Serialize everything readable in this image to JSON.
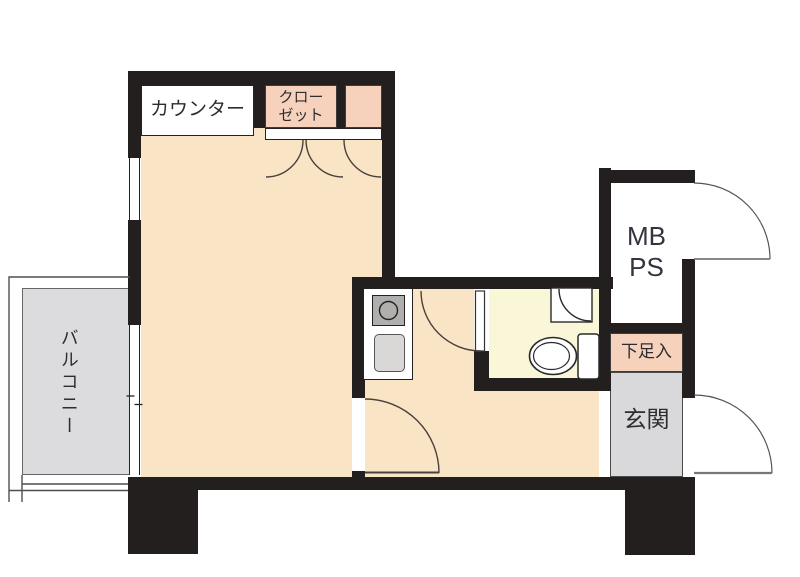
{
  "plan_title": "studio-apartment-floor-plan",
  "rooms": {
    "balcony": {
      "label": "バルコニー",
      "floor_color": "#dcdcde"
    },
    "living": {
      "floor_color": "#f9e4c6"
    },
    "counter": {
      "label": "カウンター"
    },
    "closet": {
      "label_line1": "クロー",
      "label_line2": "ゼット",
      "fill": "#f6d2bc"
    },
    "kitchen": {
      "floor_color": "#f9e4c6"
    },
    "bathroom": {
      "floor_color": "#faf7d8"
    },
    "mbps": {
      "label_line1": "MB",
      "label_line2": "PS"
    },
    "shoe_cabinet": {
      "label": "下足入",
      "fill": "#f6d2bc"
    },
    "entrance": {
      "label": "玄関",
      "floor_color": "#d9d9db"
    }
  },
  "colors": {
    "wall": "#231f1e",
    "background": "#ffffff",
    "door_arc": "#4a413b",
    "fixture_outline": "#2a2a2a",
    "stove_fill": "#b0afad",
    "sink_fill": "#d9d8d6"
  },
  "fixtures": {
    "stove": "stove-burner-icon",
    "sink": "kitchen-sink-icon",
    "toilet": "toilet-icon",
    "basin": "corner-basin-icon",
    "upper_window": "fixed-window-icon",
    "balcony_window": "sliding-window-icon"
  }
}
